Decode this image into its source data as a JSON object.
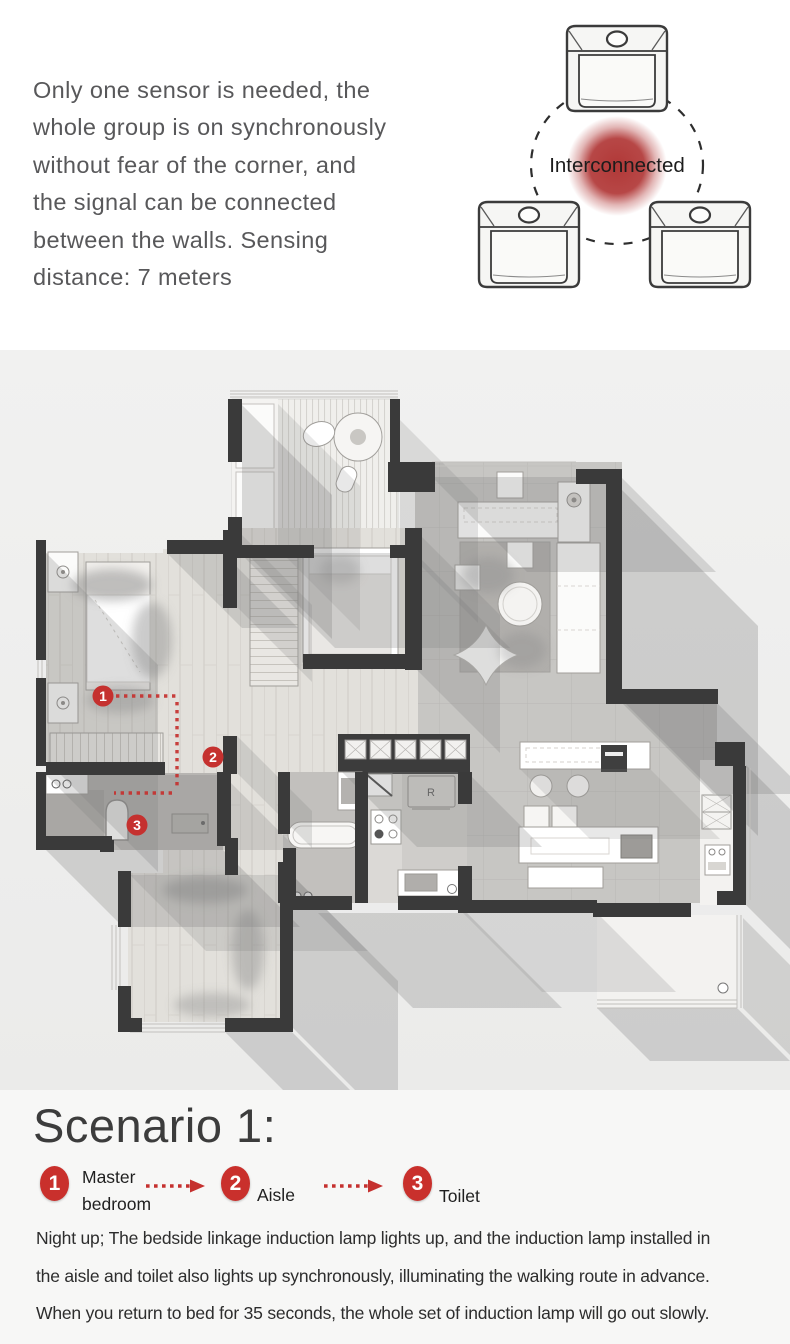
{
  "colors": {
    "accent_red": "#c5312f",
    "badge_red": "#c9302c",
    "wall_dark": "#3a3a3a",
    "intro_text_gray": "#58585a",
    "heading_gray": "#3c3c3c",
    "body_text_dark": "#2d2d2d"
  },
  "intro": {
    "lines": [
      "Only one sensor is needed, the",
      "whole group is on synchronously",
      "without fear of the corner, and",
      "the signal can be connected",
      "between the walls. Sensing",
      "distance: 7 meters"
    ]
  },
  "interconnect": {
    "label": "Interconnected",
    "device_count": 3,
    "icons": [
      "motion-sensor-icon",
      "motion-sensor-icon",
      "motion-sensor-icon"
    ]
  },
  "floorplan": {
    "fridge_label": "R",
    "markers": [
      {
        "number": "1",
        "room": "Master bedroom"
      },
      {
        "number": "2",
        "room": "Aisle"
      },
      {
        "number": "3",
        "room": "Toilet"
      }
    ]
  },
  "scenario": {
    "title": "Scenario 1:",
    "legend": [
      {
        "number": "1",
        "label": "Master bedroom"
      },
      {
        "number": "2",
        "label": "Aisle"
      },
      {
        "number": "3",
        "label": "Toilet"
      }
    ],
    "description_lines": [
      "Night up; The bedside linkage induction lamp lights up, and the induction lamp installed in",
      "the aisle and toilet also lights up synchronously, illuminating the walking route in advance.",
      "When you return to bed for 35 seconds, the whole set of induction lamp will go out slowly."
    ]
  }
}
